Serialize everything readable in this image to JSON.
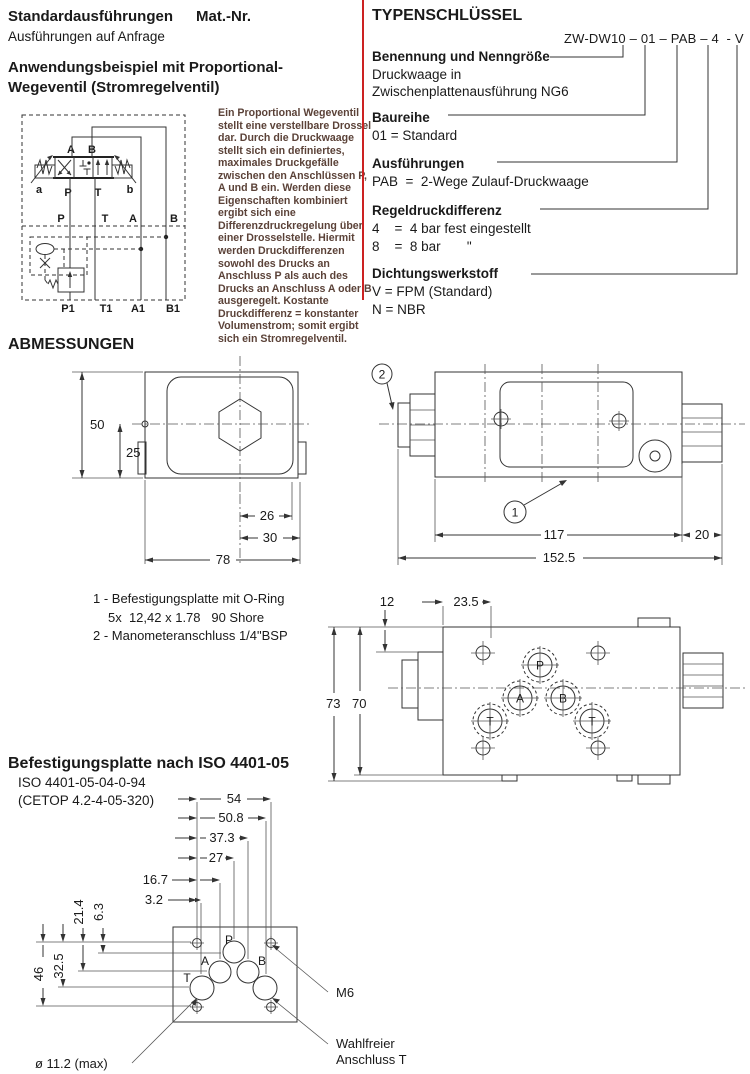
{
  "header": {
    "title": "Standardausführungen",
    "mat_nr": "Mat.-Nr.",
    "subtitle": "Ausführungen auf Anfrage"
  },
  "application": {
    "heading1": "Anwendungsbeispiel mit Proportional-",
    "heading2": "Wegeventil (Stromregelventil)",
    "body": "Ein Proportional Wegeventil\nstellt eine verstellbare Drossel\ndar. Durch die Druckwaage\nstellt sich ein definiertes,\nmaximales Druckgefälle\nzwischen den Anschlüssen P,\nA und B ein. Werden diese\nEigenschaften kombiniert\nergibt sich eine\nDifferenzdruckregelung über\neiner Drosselstelle. Hiermit\nwerden Druckdifferenzen\nsowohl des Drucks an\nAnschluss P als auch des\nDrucks an Anschluss A oder B\nausgeregelt. Kostante\nDruckdifferenz = konstanter\nVolumenstrom; somit ergibt\nsich ein Stromregelventil."
  },
  "typecode": {
    "heading": "TYPENSCHLÜSSEL",
    "code": "ZW-DW10 – 01 – PAB – 4  - V",
    "benennung": {
      "title": "Benennung und Nenngröße",
      "line1": "Druckwaage in",
      "line2": "Zwischenplattenausführung NG6"
    },
    "baureihe": {
      "title": "Baureihe",
      "line1": "01 = Standard"
    },
    "ausfuehrungen": {
      "title": "Ausführungen",
      "line1": "PAB  =  2-Wege Zulauf-Druckwaage"
    },
    "regeldruck": {
      "title": "Regeldruckdifferenz",
      "line1": "4    =  4 bar fest eingestellt",
      "line2": "8    =  8 bar       \""
    },
    "dichtung": {
      "title": "Dichtungswerkstoff",
      "line1": "V = FPM (Standard)",
      "line2": "N = NBR"
    }
  },
  "abmessungen": {
    "heading": "ABMESSUNGEN",
    "notes": {
      "n1": "1 - Befestigungsplatte mit O-Ring",
      "n2": "5x  12,42 x 1.78   90 Shore",
      "n3": "2 - Manometeranschluss 1/4\"BSP"
    },
    "front": {
      "d50": "50",
      "d25": "25",
      "d26": "26",
      "d30": "30",
      "d78": "78"
    },
    "side": {
      "b1": "1",
      "b2": "2",
      "d117": "117",
      "d20": "20",
      "d1525": "152.5"
    },
    "top": {
      "d12": "12",
      "d235": "23.5",
      "d73": "73",
      "d70": "70",
      "p": "P",
      "a": "A",
      "b": "B",
      "t1": "T",
      "t2": "T"
    }
  },
  "plate": {
    "heading": "Befestigungsplatte nach ISO 4401-05",
    "iso": "ISO 4401-05-04-0-94",
    "cetop": "(CETOP 4.2-4-05-320)",
    "d54": "54",
    "d508": "50.8",
    "d373": "37.3",
    "d27": "27",
    "d167": "16.7",
    "d32": "3.2",
    "d214": "21.4",
    "d63": "6.3",
    "d46": "46",
    "d325": "32.5",
    "p": "P",
    "a": "A",
    "b": "B",
    "t": "T",
    "m6": "M6",
    "opt1": "Wahlfreier",
    "opt2": "Anschluss T",
    "dia": "ø 11.2 (max)"
  },
  "circuit": {
    "a_top": "A",
    "b_top": "B",
    "act_a": "a",
    "act_b": "b",
    "p_valve": "P",
    "t_valve": "T",
    "p_mid": "P",
    "t_mid": "T",
    "a_mid": "A",
    "b_mid": "B",
    "p1": "P1",
    "t1": "T1",
    "a1": "A1",
    "b1": "B1"
  },
  "colors": {
    "accent": "#cc2222",
    "ink": "#1a1a1a",
    "body_text": "#5b4238",
    "line": "#333333"
  }
}
